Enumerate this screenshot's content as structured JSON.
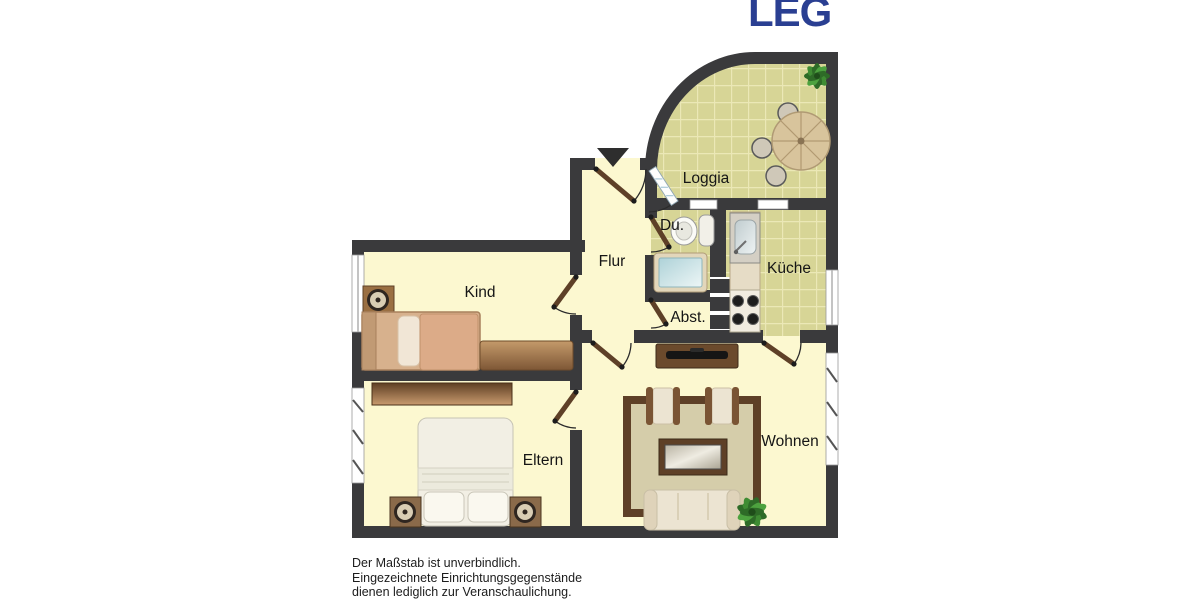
{
  "logo": {
    "text": "LEG"
  },
  "rooms": {
    "loggia": "Loggia",
    "dusche": "Du.",
    "kueche": "Küche",
    "flur": "Flur",
    "kind": "Kind",
    "abstellraum": "Abst.",
    "eltern": "Eltern",
    "wohnen": "Wohnen"
  },
  "disclaimer": {
    "line1": "Der Maßstab ist unverbindlich.",
    "line2": "Eingezeichnete Einrichtungsgegenstände",
    "line3": "dienen lediglich zur Veranschaulichung."
  },
  "colors": {
    "logo_blue": "#2a3f92",
    "wall": "#3a3a3c",
    "floor": "#fcf8d0",
    "tile": "#d7d596",
    "tile_grout": "#ebe8b6",
    "door_leaf": "#5e4027",
    "rug_border": "#5e4027",
    "rug_fill": "#d5cdaa",
    "plant_green": "#3f8c33",
    "window_white": "#ffffff"
  }
}
